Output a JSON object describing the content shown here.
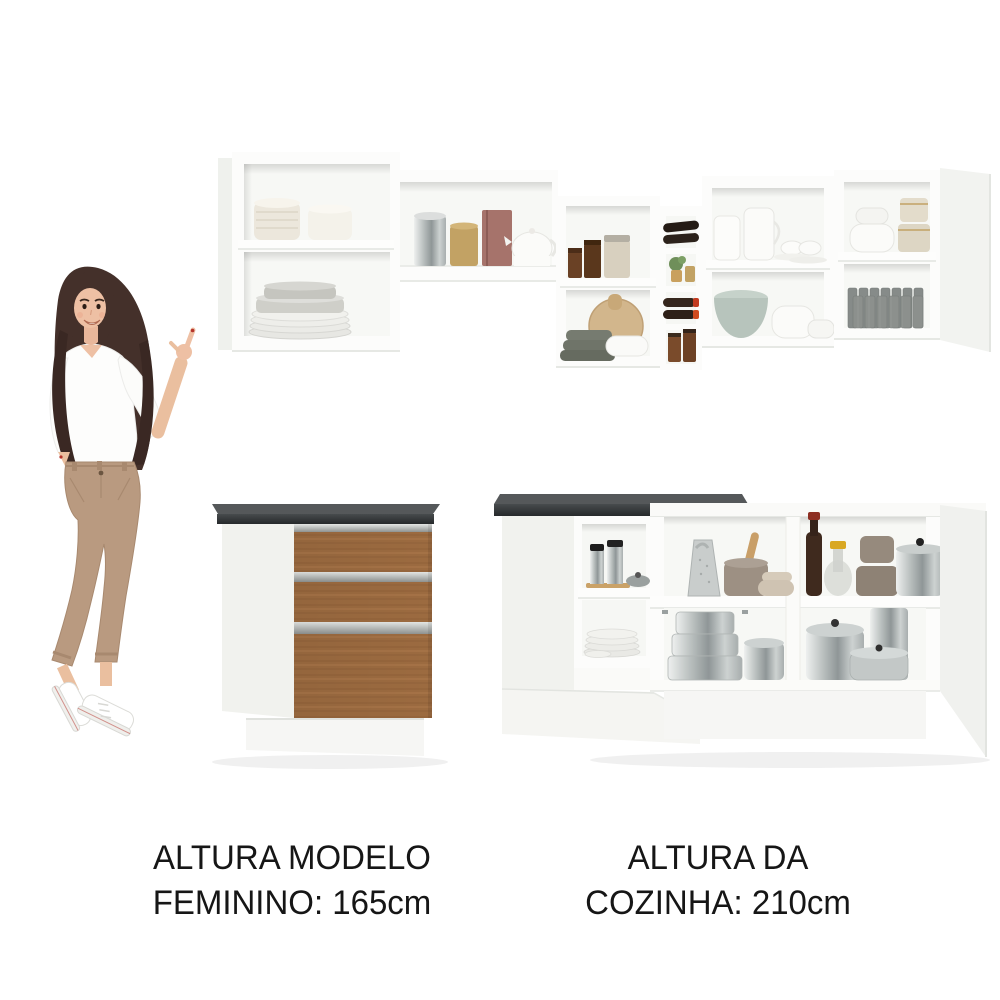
{
  "image": {
    "type": "kitchen-furniture-product-collage",
    "background": "#ffffff",
    "alt": "White modular kitchen set with open wall cabinets full of dishware, a base drawer cabinet with wood drawers and dark countertop, a corner base counter with pots, and a female model pointing at the cabinets"
  },
  "captions": {
    "model": {
      "line1": "ALTURA MODELO",
      "line2": "FEMININO: 165cm"
    },
    "kitchen": {
      "line1": "ALTURA DA",
      "line2": "COZINHA: 210cm"
    }
  },
  "measurements": {
    "model_height_cm": "165cm",
    "kitchen_height_cm": "210cm"
  },
  "colors": {
    "text": "#161616",
    "cabinet_white": "#fcfcfb",
    "cabinet_interior": "#f7f8f5",
    "countertop_dark": "#2f3234",
    "drawer_wood": "#9c6b40",
    "handle_rail": "#c3c6c4",
    "model_top_white": "#fdfdfc",
    "model_pants_tan": "#b99a80",
    "model_hair_brown": "#44302a"
  }
}
